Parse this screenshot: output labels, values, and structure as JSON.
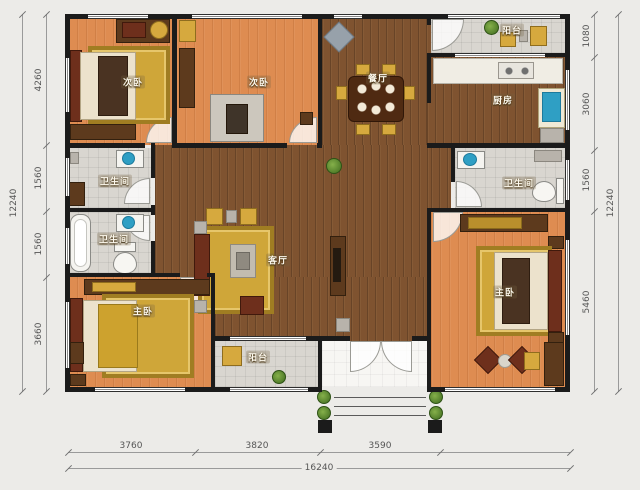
{
  "rooms": [
    {
      "id": "bedroom-nw",
      "label": "次卧"
    },
    {
      "id": "bedroom-n",
      "label": "次卧"
    },
    {
      "id": "dining",
      "label": "餐厅"
    },
    {
      "id": "balcony-ne",
      "label": "阳台"
    },
    {
      "id": "kitchen",
      "label": "厨房"
    },
    {
      "id": "bath-w1",
      "label": "卫生间"
    },
    {
      "id": "bath-w2",
      "label": "卫生间"
    },
    {
      "id": "bath-e",
      "label": "卫生间"
    },
    {
      "id": "living",
      "label": "客厅"
    },
    {
      "id": "bedroom-sw",
      "label": "主卧"
    },
    {
      "id": "balcony-s",
      "label": "阳台"
    },
    {
      "id": "bedroom-se",
      "label": "主卧"
    }
  ],
  "dims": {
    "left_total": "12240",
    "left_segments": [
      "4260",
      "1560",
      "1560",
      "3660"
    ],
    "right_segments": [
      "1080",
      "3060",
      "1560",
      "5460"
    ],
    "right_total": "12240",
    "bottom_segments": [
      "3760",
      "3820",
      "3590"
    ],
    "bottom_total": "16240"
  },
  "colors": {
    "wall": "#1b1b1b",
    "floor_bedroom": "#de8c51",
    "floor_living": "#7f5330",
    "floor_tile": "#d9d6d0",
    "furniture_gold": "#d6a93e",
    "fixture_teal": "#2f9fc4",
    "background": "#ecebe8"
  }
}
